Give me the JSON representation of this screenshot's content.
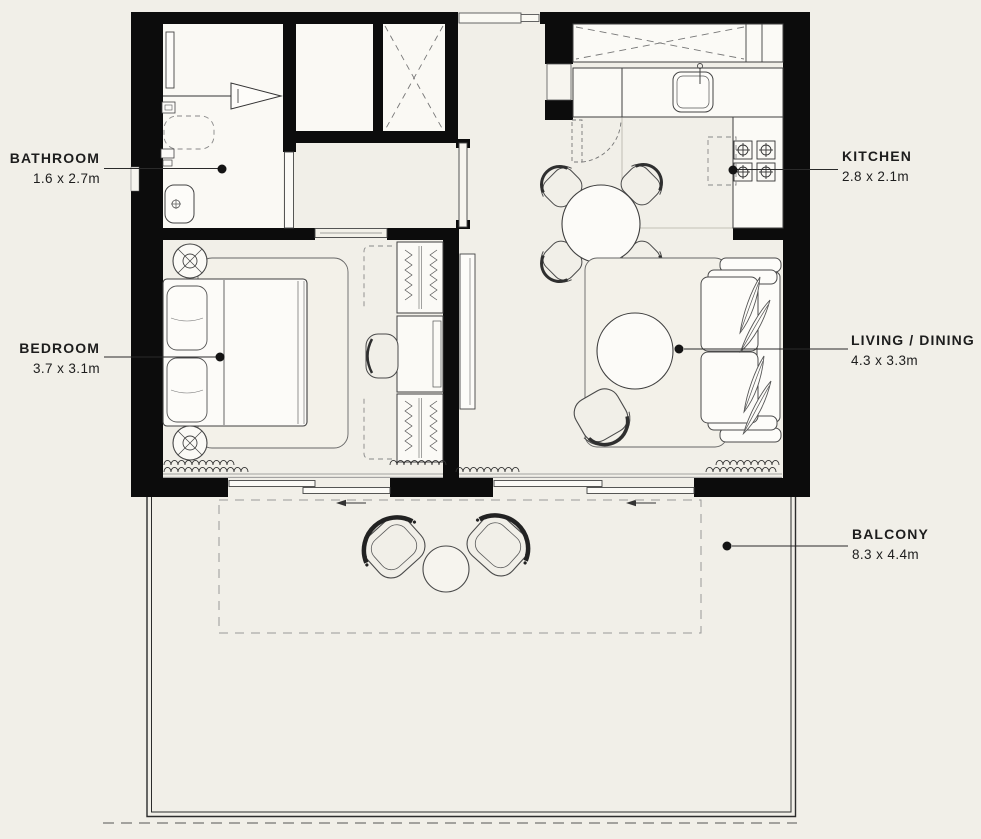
{
  "title": "Apartment floor plan",
  "colors": {
    "background": "#f1efe8",
    "wall": "#0c0c0c",
    "fixture_fill": "#fbfaf6",
    "line": "#3f3f3f",
    "dashed": "#888888",
    "text": "#1d1d1d"
  },
  "labels": {
    "bathroom": {
      "name": "BATHROOM",
      "dims": "1.6 x 2.7m"
    },
    "bedroom": {
      "name": "BEDROOM",
      "dims": "3.7 x 3.1m"
    },
    "kitchen": {
      "name": "KITCHEN",
      "dims": "2.8 x 2.1m"
    },
    "living": {
      "name": "LIVING / DINING",
      "dims": "4.3 x 3.3m"
    },
    "balcony": {
      "name": "BALCONY",
      "dims": "8.3 x 4.4m"
    }
  }
}
